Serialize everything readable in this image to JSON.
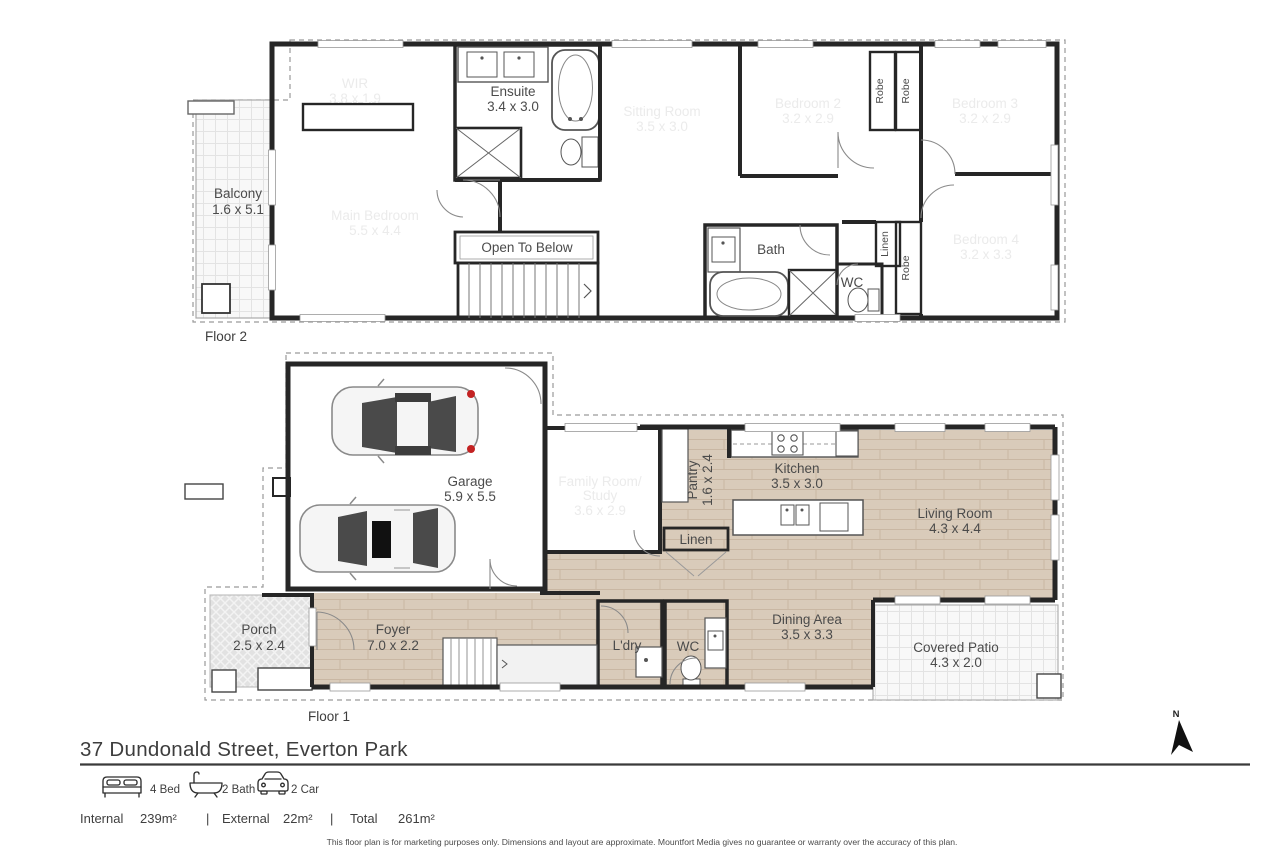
{
  "address": "37 Dundonald Street, Everton Park",
  "legend": {
    "beds": "4 Bed",
    "baths": "2 Bath",
    "cars": "2 Car"
  },
  "areas": {
    "internal_label": "Internal",
    "internal_value": "239m²",
    "separator": "|",
    "external_label": "External",
    "external_value": "22m²",
    "total_label": "Total",
    "total_value": "261m²"
  },
  "disclaimer": "This floor plan is for marketing purposes only. Dimensions and layout are approximate. Mountfort Media gives no guarantee or warranty over the accuracy of this plan.",
  "compass": {
    "north": "N"
  },
  "floor2": {
    "label": "Floor 2",
    "wir": {
      "name": "WIR",
      "dims": "3.8 x 1.9"
    },
    "ensuite": {
      "name": "Ensuite",
      "dims": "3.4 x 3.0"
    },
    "sitting": {
      "name": "Sitting Room",
      "dims": "3.5 x 3.0"
    },
    "bed2": {
      "name": "Bedroom 2",
      "dims": "3.2 x 2.9"
    },
    "bed3": {
      "name": "Bedroom 3",
      "dims": "3.2 x 2.9"
    },
    "bed4": {
      "name": "Bedroom 4",
      "dims": "3.2 x 3.3"
    },
    "main_bed": {
      "name": "Main Bedroom",
      "dims": "5.5 x 4.4"
    },
    "balcony": {
      "name": "Balcony",
      "dims": "1.6 x 5.1"
    },
    "bath": {
      "name": "Bath"
    },
    "wc": {
      "name": "WC"
    },
    "open_below": {
      "name": "Open To Below"
    },
    "robe1": "Robe",
    "robe2": "Robe",
    "linen": "Linen",
    "robe3": "Robe"
  },
  "floor1": {
    "label": "Floor 1",
    "garage": {
      "name": "Garage",
      "dims": "5.9 x 5.5"
    },
    "family": {
      "line1": "Family Room/",
      "line2": "Study",
      "dims": "3.6 x 2.9"
    },
    "pantry": {
      "name": "Pantry",
      "dims": "1.6 x 2.4"
    },
    "kitchen": {
      "name": "Kitchen",
      "dims": "3.5 x 3.0"
    },
    "living": {
      "name": "Living Room",
      "dims": "4.3 x 4.4"
    },
    "porch": {
      "name": "Porch",
      "dims": "2.5 x 2.4"
    },
    "foyer": {
      "name": "Foyer",
      "dims": "7.0 x 2.2"
    },
    "laundry": {
      "name": "L'dry"
    },
    "wc": {
      "name": "WC"
    },
    "dining": {
      "name": "Dining Area",
      "dims": "3.5 x 3.3"
    },
    "patio": {
      "name": "Covered Patio",
      "dims": "4.3 x 2.0"
    },
    "linen": {
      "name": "Linen"
    }
  },
  "colors": {
    "dark_room": "#646464",
    "wet_room": "#d4e6f0",
    "wood_floor": "#d9cbba",
    "garage_floor": "#ececec",
    "wall": "#262626",
    "accent_red": "#c32222"
  }
}
